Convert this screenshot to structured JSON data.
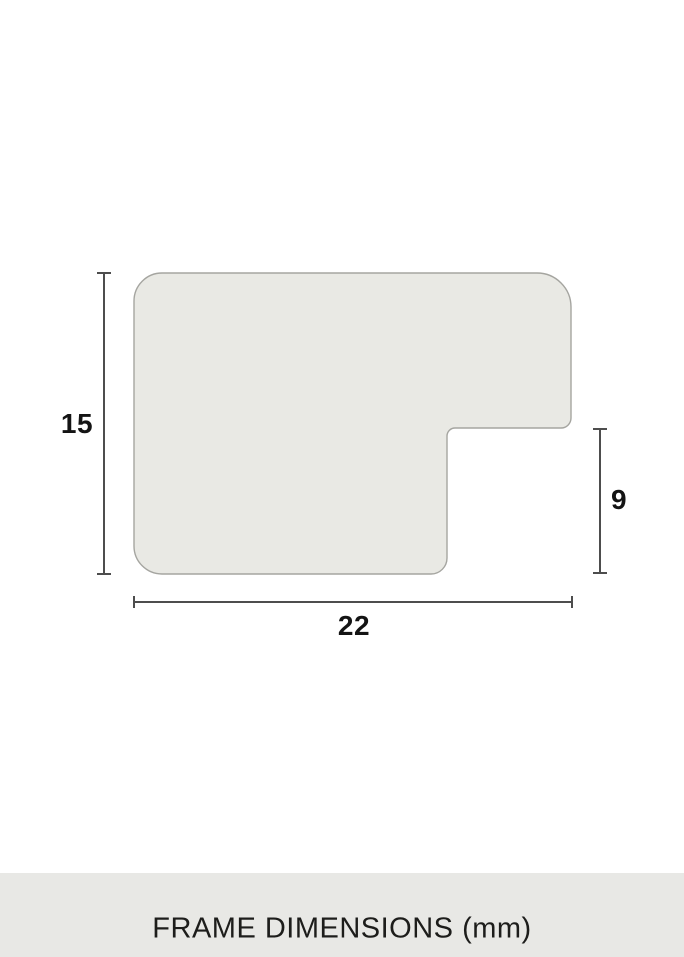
{
  "diagram": {
    "dimensions": {
      "height": "15",
      "width": "22",
      "rabbet_depth": "9"
    },
    "shape_name": "frame-profile-cross-section"
  },
  "caption": {
    "text": "FRAME DIMENSIONS (mm)"
  },
  "colors": {
    "page_bg": "#ffffff",
    "shape_fill": "#e9e9e4",
    "shape_stroke": "#a5a5a0",
    "dimension_line": "#4d4d4d",
    "label_text": "#141414",
    "caption_bar_bg": "#e8e8e5",
    "caption_text": "#1d1d1b"
  }
}
